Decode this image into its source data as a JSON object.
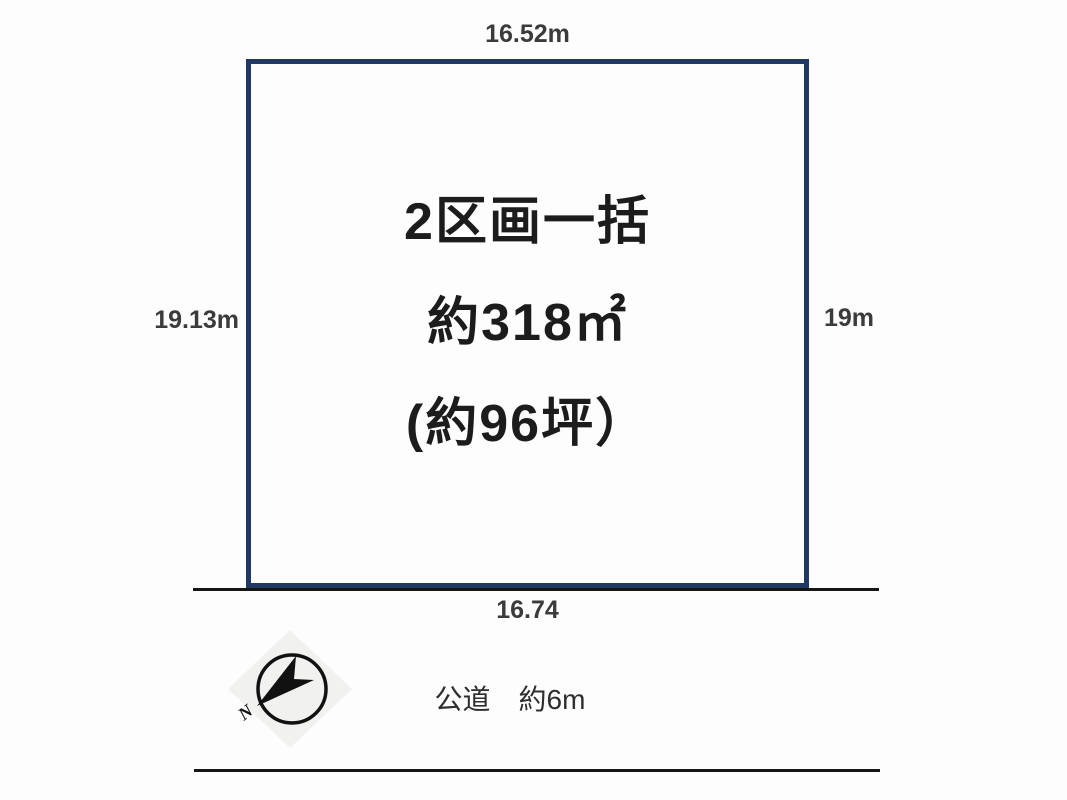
{
  "diagram": {
    "parcel": {
      "line1": "2区画一括",
      "line2": "約318㎡",
      "line3": "(約96坪）"
    },
    "dimensions": {
      "top": "16.52m",
      "left": "19.13m",
      "right": "19m",
      "bottom": "16.74"
    },
    "road": {
      "label": "公道　約6m"
    },
    "compass": {
      "label": "N"
    },
    "colors": {
      "parcel_border": "#1f3864",
      "road_line": "#161616",
      "text": "#1c1c1c",
      "compass_bg": "#f1f1ef",
      "compass_ink": "#111111"
    }
  }
}
